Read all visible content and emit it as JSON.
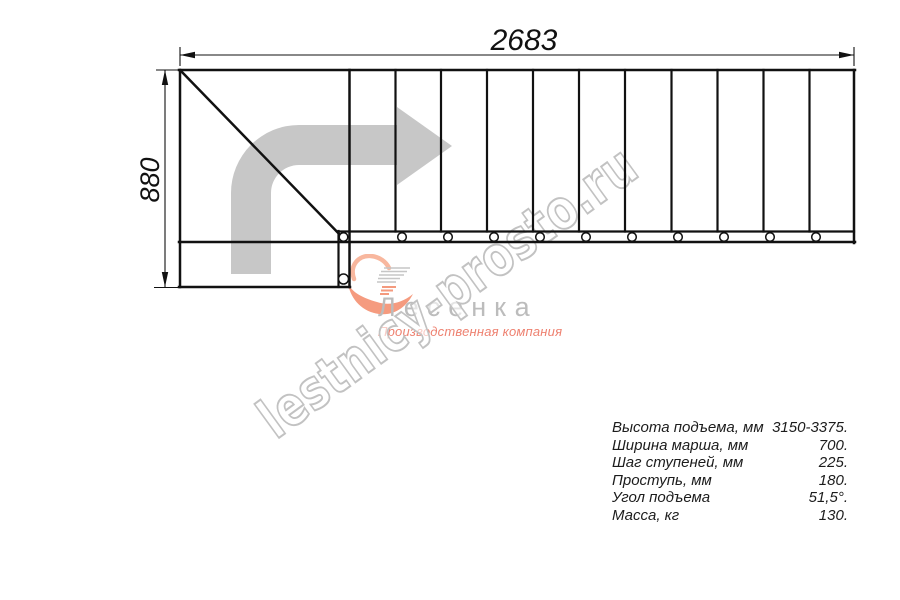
{
  "page": {
    "background": "#ffffff"
  },
  "drawing": {
    "width_label": "2683",
    "height_label": "880",
    "line_color": "#111111",
    "arrow_color": "#c7c7c7"
  },
  "watermark": {
    "text": "lestnicy-prosto.ru",
    "outline_color": "#c2c2c2"
  },
  "logo": {
    "name": "Лесенка",
    "tagline": "Производственная компания",
    "name_color": "#bcbcbc",
    "tagline_color": "#ee8170"
  },
  "specs": {
    "rows": [
      {
        "label": "Высота подъема, мм",
        "value": "3150-3375."
      },
      {
        "label": "Ширина марша, мм",
        "value": "700."
      },
      {
        "label": "Шаг ступеней, мм",
        "value": "225."
      },
      {
        "label": "Проступь, мм",
        "value": "180."
      },
      {
        "label": "Угол подъема",
        "value": "51,5°."
      },
      {
        "label": "Масса, кг",
        "value": "130."
      }
    ]
  }
}
